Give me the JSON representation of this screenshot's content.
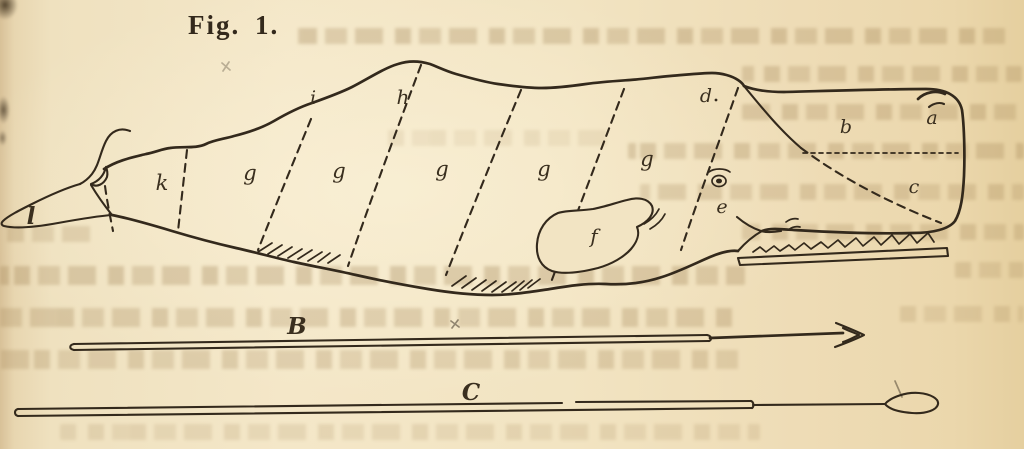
{
  "figure_title": "Fig. 1.",
  "labels": {
    "l": "l",
    "k": "k",
    "g": "g",
    "i": "i",
    "h": "h",
    "d": "d",
    "e": "e",
    "f": "f",
    "b": "b",
    "a": "a",
    "c": "c"
  },
  "implements": {
    "harpoon": "B",
    "lance": "C"
  },
  "colors": {
    "paper": "#f1e3c2",
    "paper_edge": "#e5cf9f",
    "ink": "#33291c",
    "label_ink": "#3a2f1f"
  }
}
